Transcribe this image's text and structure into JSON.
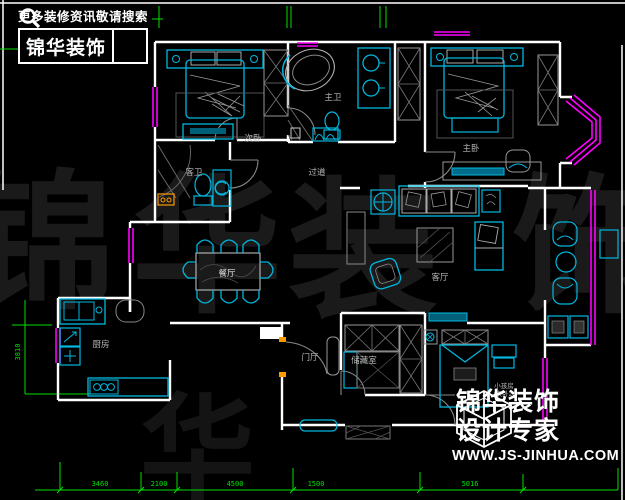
{
  "branding": {
    "top_left": {
      "slogan": "更多装修资讯敬请搜索",
      "logo_text": "锦华装饰",
      "search_icon": "magnifier"
    },
    "bottom_right": {
      "logo_line1": "锦华装饰",
      "logo_line2": "设计专家",
      "website": "WWW.JS-JINHUA.COM",
      "cube_icon": "wireframe-cube"
    }
  },
  "watermark": {
    "char1": "锦",
    "char2": "华",
    "char3": "装",
    "char4": "饰",
    "color": "#1a1a1a"
  },
  "floorplan": {
    "rooms": [
      {
        "id": "second-bedroom",
        "label": "次卧"
      },
      {
        "id": "master-bathroom",
        "label": "主卫"
      },
      {
        "id": "master-bedroom",
        "label": "主卧"
      },
      {
        "id": "hallway",
        "label": "过道"
      },
      {
        "id": "guest-bathroom",
        "label": "客卫"
      },
      {
        "id": "dining-room",
        "label": "餐厅"
      },
      {
        "id": "living-room",
        "label": "客厅"
      },
      {
        "id": "kitchen",
        "label": "厨房"
      },
      {
        "id": "entry-hall",
        "label": "门厅"
      },
      {
        "id": "storage-room",
        "label": "储藏室"
      },
      {
        "id": "kids-room",
        "label": "小孩房",
        "sublabel": "(次卧2)"
      }
    ],
    "dimensions": {
      "bottom_labels": [
        "3460",
        "2100",
        "4500",
        "1500",
        "5016"
      ],
      "left_label": "3810"
    },
    "colors": {
      "wall": "#ffffff",
      "furniture": "#00b8e0",
      "window": "#ff00ff",
      "dimension": "#00e000",
      "accent": "#ff9a00",
      "room_label": "#b8b8b8"
    }
  }
}
